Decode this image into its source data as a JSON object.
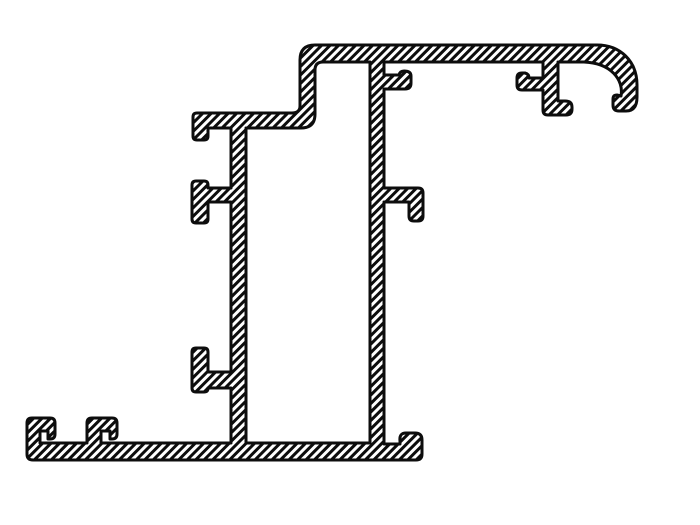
{
  "canvas": {
    "width": 700,
    "height": 525,
    "background": "#ffffff"
  },
  "style": {
    "line_color": "#0d0d0d",
    "stroke_width": 3,
    "hatch": {
      "period": 6,
      "thickness": 3,
      "angle": -45,
      "stripe_color": "#0d0d0d",
      "gap_color": "#ffffff"
    }
  },
  "drawing": {
    "kind": "section-hatched-extrusion-profile",
    "shapes": [
      {
        "name": "profile-outline",
        "fill_rule": "evenodd",
        "path": "M315 45 L597 45 C620 45 637 61 637 85 L637 97 Q637 111 626 111 L619 111 Q613 111 613 105 L613 99 Q613 95 617 95 L621 96 C624 80 611 63 584 62 L558 62 L558 101 L565 101 Q572 101 572 107 L572 109 Q572 115 566 115 L548 115 Q543 115 543 110 L543 90 L522 90 Q517 90 517 85 L517 78 Q517 73 522 73 L525 73 Q529 74 529 78 L543 78 L543 62 L384 62 L384 75 L399 75 Q400 71 404 71 Q411 71 411 76 L411 83 Q411 89 405 89 L384 89 L384 188 L418 188 Q423 188 423 193 L423 216 Q423 221 418 221 L414 221 Q409 221 409 216 L409 202 L384 202 L384 444 L400 444 L400 441 Q399 433 406 433 L415 433 Q422 433 422 440 L422 454 Q422 460 416 460 L33 460 Q27 460 27 454 L27 423 Q27 418 32 418 L50 418 Q55 418 55 423 L55 434 Q55 439 50 439 L48 439 L48 431 L40 431 L40 443 L87 443 L87 423 Q87 418 92 418 L112 418 Q117 418 117 423 L117 434 Q117 439 112 439 L110 439 L110 431 L101 431 L101 443 L231 443 L231 388 L208 388 Q208 392 204 392 L196 392 Q192 392 192 388 L192 352 Q192 348 196 348 L204 348 Q208 348 208 352 L208 372 L231 372 L231 202 L208 202 L208 219 Q208 223 204 223 L196 223 Q192 223 192 219 L192 185 Q192 181 196 181 L204 181 Q208 181 208 185 L208 188 L231 188 L231 128 L208 128 L208 136 Q208 140 204 140 L197 140 Q193 140 193 136 L193 117 Q193 113 197 113 L292 113 Q300 113 300 106 L300 60 Q300 45 315 45 Z M246 128 L301 128 Q315 128 315 114 L315 70 Q315 62 323 62 L370 62 L370 443 L246 443 Z"
      }
    ]
  }
}
